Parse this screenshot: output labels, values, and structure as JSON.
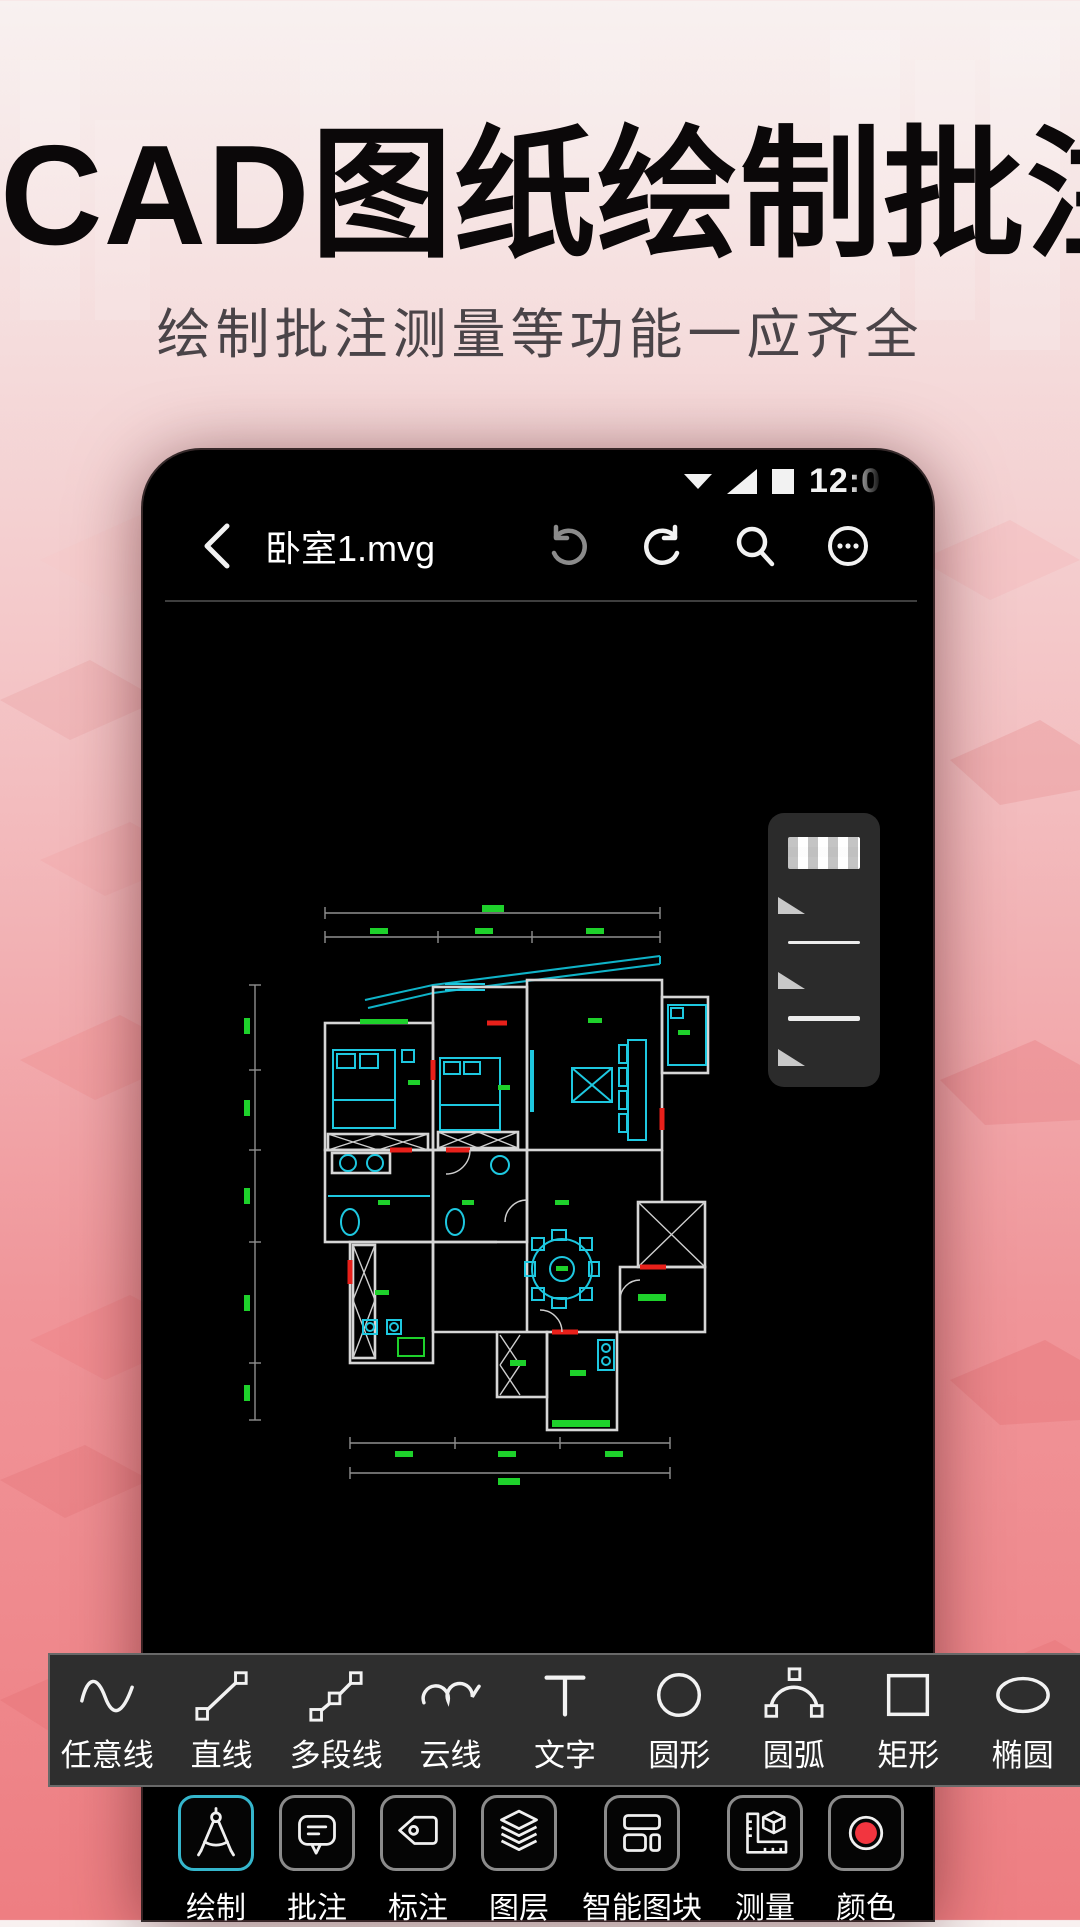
{
  "hero": {
    "title": "CAD图纸绘制批注",
    "subtitle": "绘制批注测量等功能一应齐全"
  },
  "phone": {
    "status_bar": {
      "time": "12:0",
      "icons": [
        "caret-down-icon",
        "signal-icon",
        "battery-icon"
      ]
    },
    "top_bar": {
      "file_name": "卧室1.mvg",
      "icons": [
        "back-icon",
        "undo-icon",
        "redo-icon",
        "search-icon",
        "more-icon"
      ],
      "undo_disabled": true
    },
    "line_style_panel": {
      "items": [
        "transparency-swatch",
        "corner-triangle",
        "thin-line",
        "corner-triangle",
        "medium-line",
        "corner-triangle"
      ]
    },
    "canvas": {
      "content": "apartment-floor-plan"
    }
  },
  "draw_toolbar": {
    "tools": [
      {
        "label": "任意线",
        "icon": "freehand-line-icon"
      },
      {
        "label": "直线",
        "icon": "straight-line-icon"
      },
      {
        "label": "多段线",
        "icon": "polyline-icon"
      },
      {
        "label": "云线",
        "icon": "cloud-line-icon"
      },
      {
        "label": "文字",
        "icon": "text-icon"
      },
      {
        "label": "圆形",
        "icon": "circle-icon"
      },
      {
        "label": "圆弧",
        "icon": "arc-icon"
      },
      {
        "label": "矩形",
        "icon": "rectangle-icon"
      },
      {
        "label": "椭圆",
        "icon": "ellipse-icon"
      }
    ]
  },
  "mode_toolbar": {
    "items": [
      {
        "label": "绘制",
        "icon": "compass-icon",
        "selected": true
      },
      {
        "label": "批注",
        "icon": "comment-icon",
        "selected": false
      },
      {
        "label": "标注",
        "icon": "tag-icon",
        "selected": false
      },
      {
        "label": "图层",
        "icon": "layers-icon",
        "selected": false
      },
      {
        "label": "智能图块",
        "icon": "smart-blocks-icon",
        "selected": false
      },
      {
        "label": "测量",
        "icon": "measure-icon",
        "selected": false
      },
      {
        "label": "颜色",
        "icon": "color-icon",
        "selected": false
      }
    ]
  },
  "colors": {
    "accent_cyan": "#35b6cc",
    "color_tool_red": "#f2353f",
    "cad_wall": "#d6d6d6",
    "cad_furniture": "#1ec8e0",
    "cad_dimension_green": "#1ed12b",
    "cad_door_red": "#e8201a",
    "hero_title": "#0b0809",
    "background_top": "#f8f1f0",
    "background_bottom": "#ee7e82"
  }
}
